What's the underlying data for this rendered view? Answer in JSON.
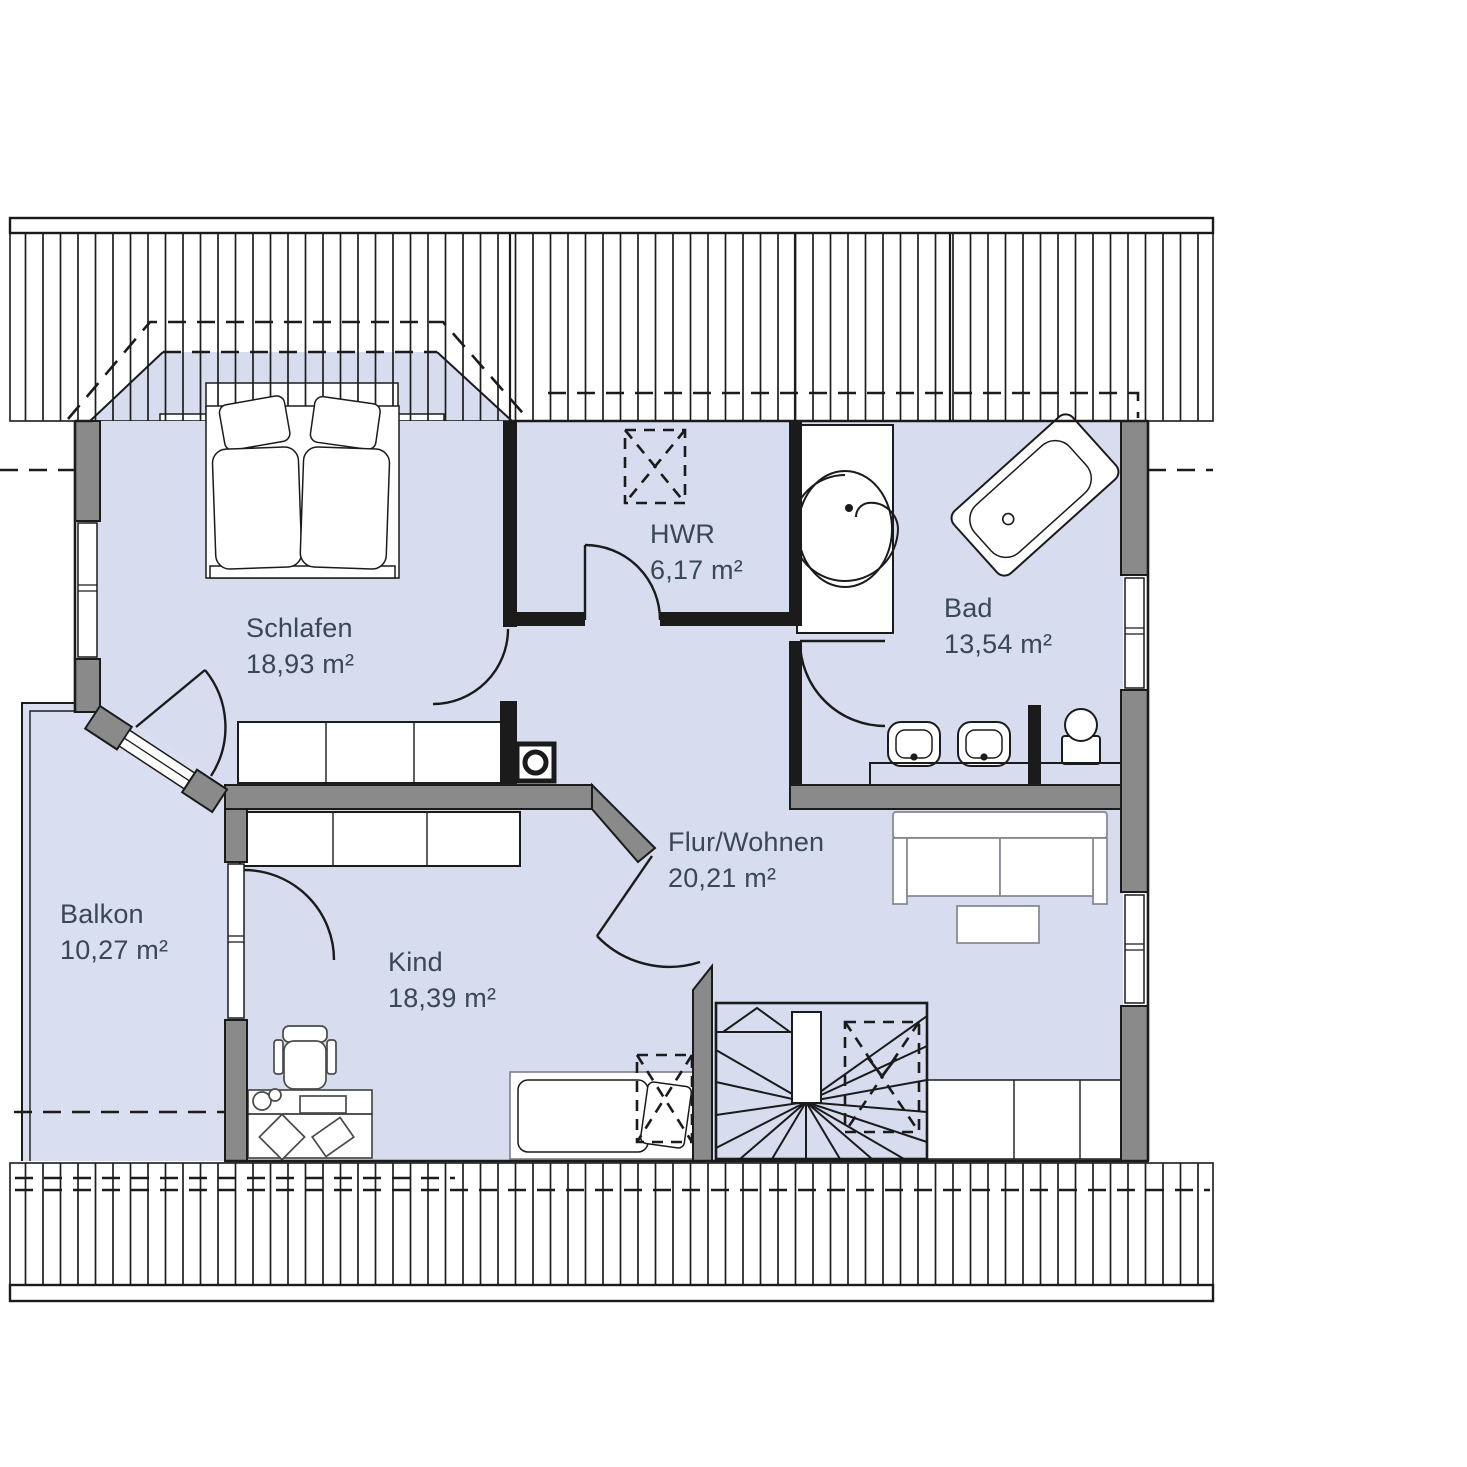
{
  "rooms": [
    {
      "id": "schlafen",
      "label": "Schlafen",
      "area": "18,93 m²"
    },
    {
      "id": "hwr",
      "label": "HWR",
      "area": "6,17 m²"
    },
    {
      "id": "bad",
      "label": "Bad",
      "area": "13,54 m²"
    },
    {
      "id": "flur",
      "label": "Flur/Wohnen",
      "area": "20,21 m²"
    },
    {
      "id": "kind",
      "label": "Kind",
      "area": "18,39 m²"
    },
    {
      "id": "balkon",
      "label": "Balkon",
      "area": "10,27 m²"
    }
  ],
  "colors": {
    "room_fill": "#d7ddef",
    "balcony_fill": "#d9dff0",
    "wall_gray": "#8a8a8a",
    "line": "#1b1b1b",
    "text": "#3a4754",
    "furniture_stroke": "#4a4a4a",
    "light_stroke": "#82878f"
  }
}
